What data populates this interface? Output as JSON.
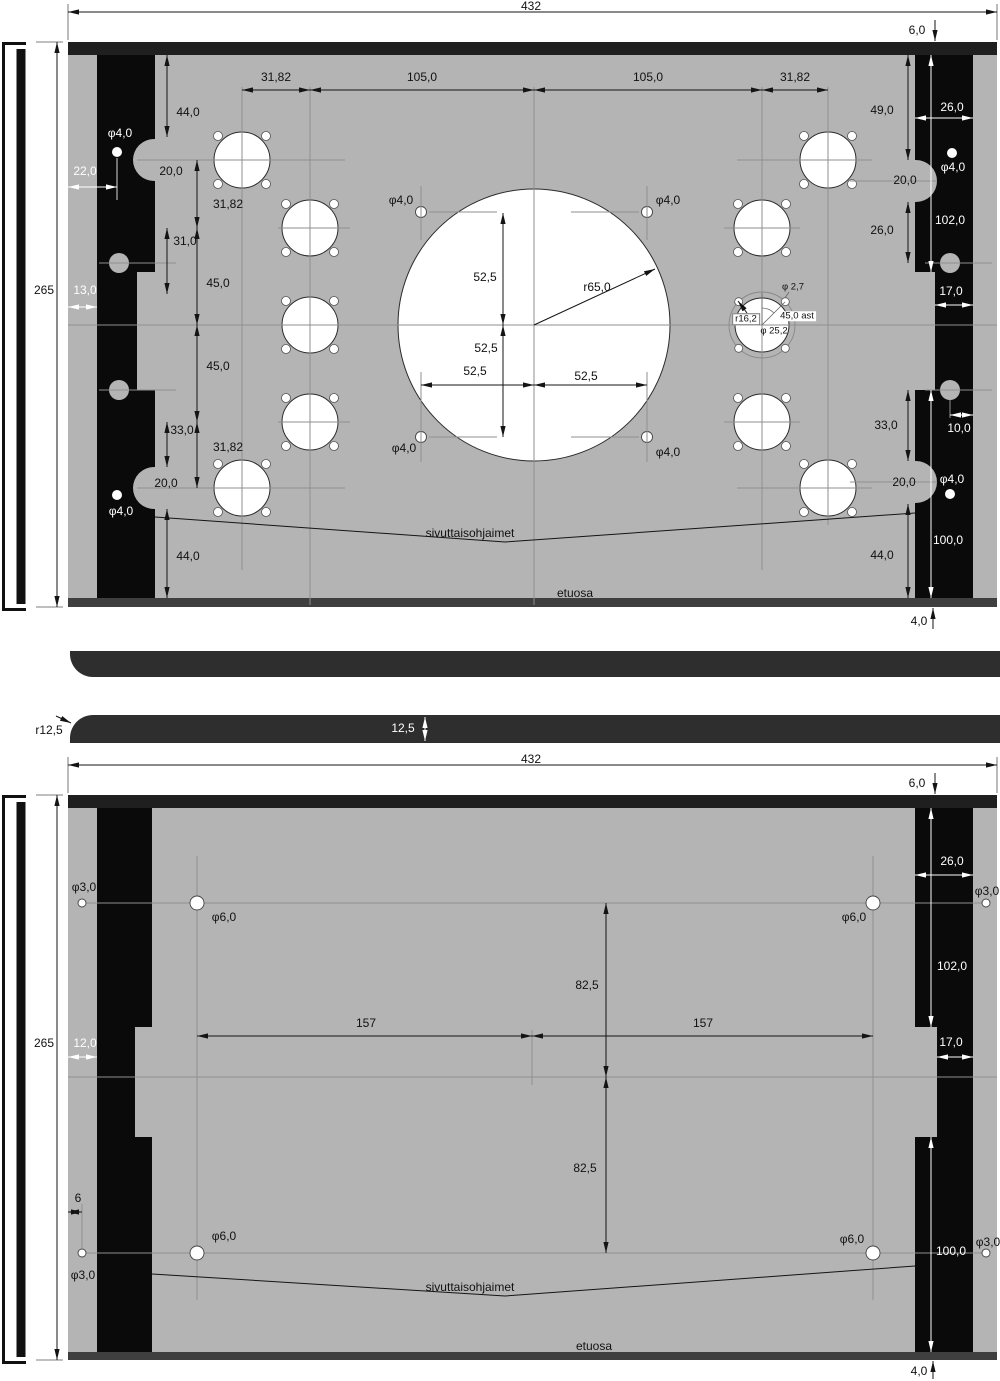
{
  "front_view": {
    "overall_width": "432",
    "height": "265",
    "top_thickness": "6,0",
    "bottom_thickness": "4,0",
    "top_chain": [
      "31,82",
      "105,0",
      "105,0",
      "31,82"
    ],
    "left_chain": [
      "44,0",
      "20,0",
      "31,82",
      "31,0",
      "45,0",
      "45,0",
      "33,0",
      "31,82",
      "20,0",
      "44,0"
    ],
    "left_bar": {
      "hole_top": "φ4,0",
      "offset_22": "22,0",
      "offset_13": "13,0",
      "hole_bottom": "φ4,0"
    },
    "right_chain": [
      "49,0",
      "20,0",
      "26,0",
      "33,0",
      "20,0",
      "44,0"
    ],
    "right_bar": {
      "width": "26,0",
      "hole_top": "φ4,0",
      "height_top": "102,0",
      "width_lower": "17,0",
      "hole_offset": "10,0",
      "hole_bottom": "φ4,0",
      "height_bottom": "100,0"
    },
    "center_circle": {
      "radius": "r65,0",
      "v_offset_top": "52,5",
      "v_offset_bottom": "52,5",
      "h_offset_left": "52,5",
      "h_offset_right": "52,5",
      "corner_holes": [
        "φ4,0",
        "φ4,0",
        "φ4,0",
        "φ4,0"
      ]
    },
    "special_hole": {
      "bolt_hole": "φ 2,7",
      "bolt_circle_radius": "r16,2",
      "bolt_angle": "45,0 ast",
      "bore": "φ 25,2"
    },
    "callout": "sivuttaisohjaimet",
    "area_label": "etuosa"
  },
  "side_view": {
    "corner_radius": "r12,5",
    "thickness": "12,5"
  },
  "back_view": {
    "overall_width": "432",
    "height": "265",
    "top_thickness": "6,0",
    "bottom_thickness": "4,0",
    "hole_spacing_left": "157",
    "hole_spacing_right": "157",
    "row_offset_top": "82,5",
    "row_offset_bottom": "82,5",
    "edge_offset": "12,0",
    "hole_edge_offset": "6",
    "holes_small": [
      "φ3,0",
      "φ3,0",
      "φ3,0",
      "φ3,0"
    ],
    "holes_large": [
      "φ6,0",
      "φ6,0",
      "φ6,0",
      "φ6,0"
    ],
    "right_bar": {
      "width": "26,0",
      "height_top": "102,0",
      "width_lower": "17,0",
      "height_bottom": "100,0"
    },
    "callout": "sivuttaisohjaimet",
    "area_label": "etuosa"
  }
}
